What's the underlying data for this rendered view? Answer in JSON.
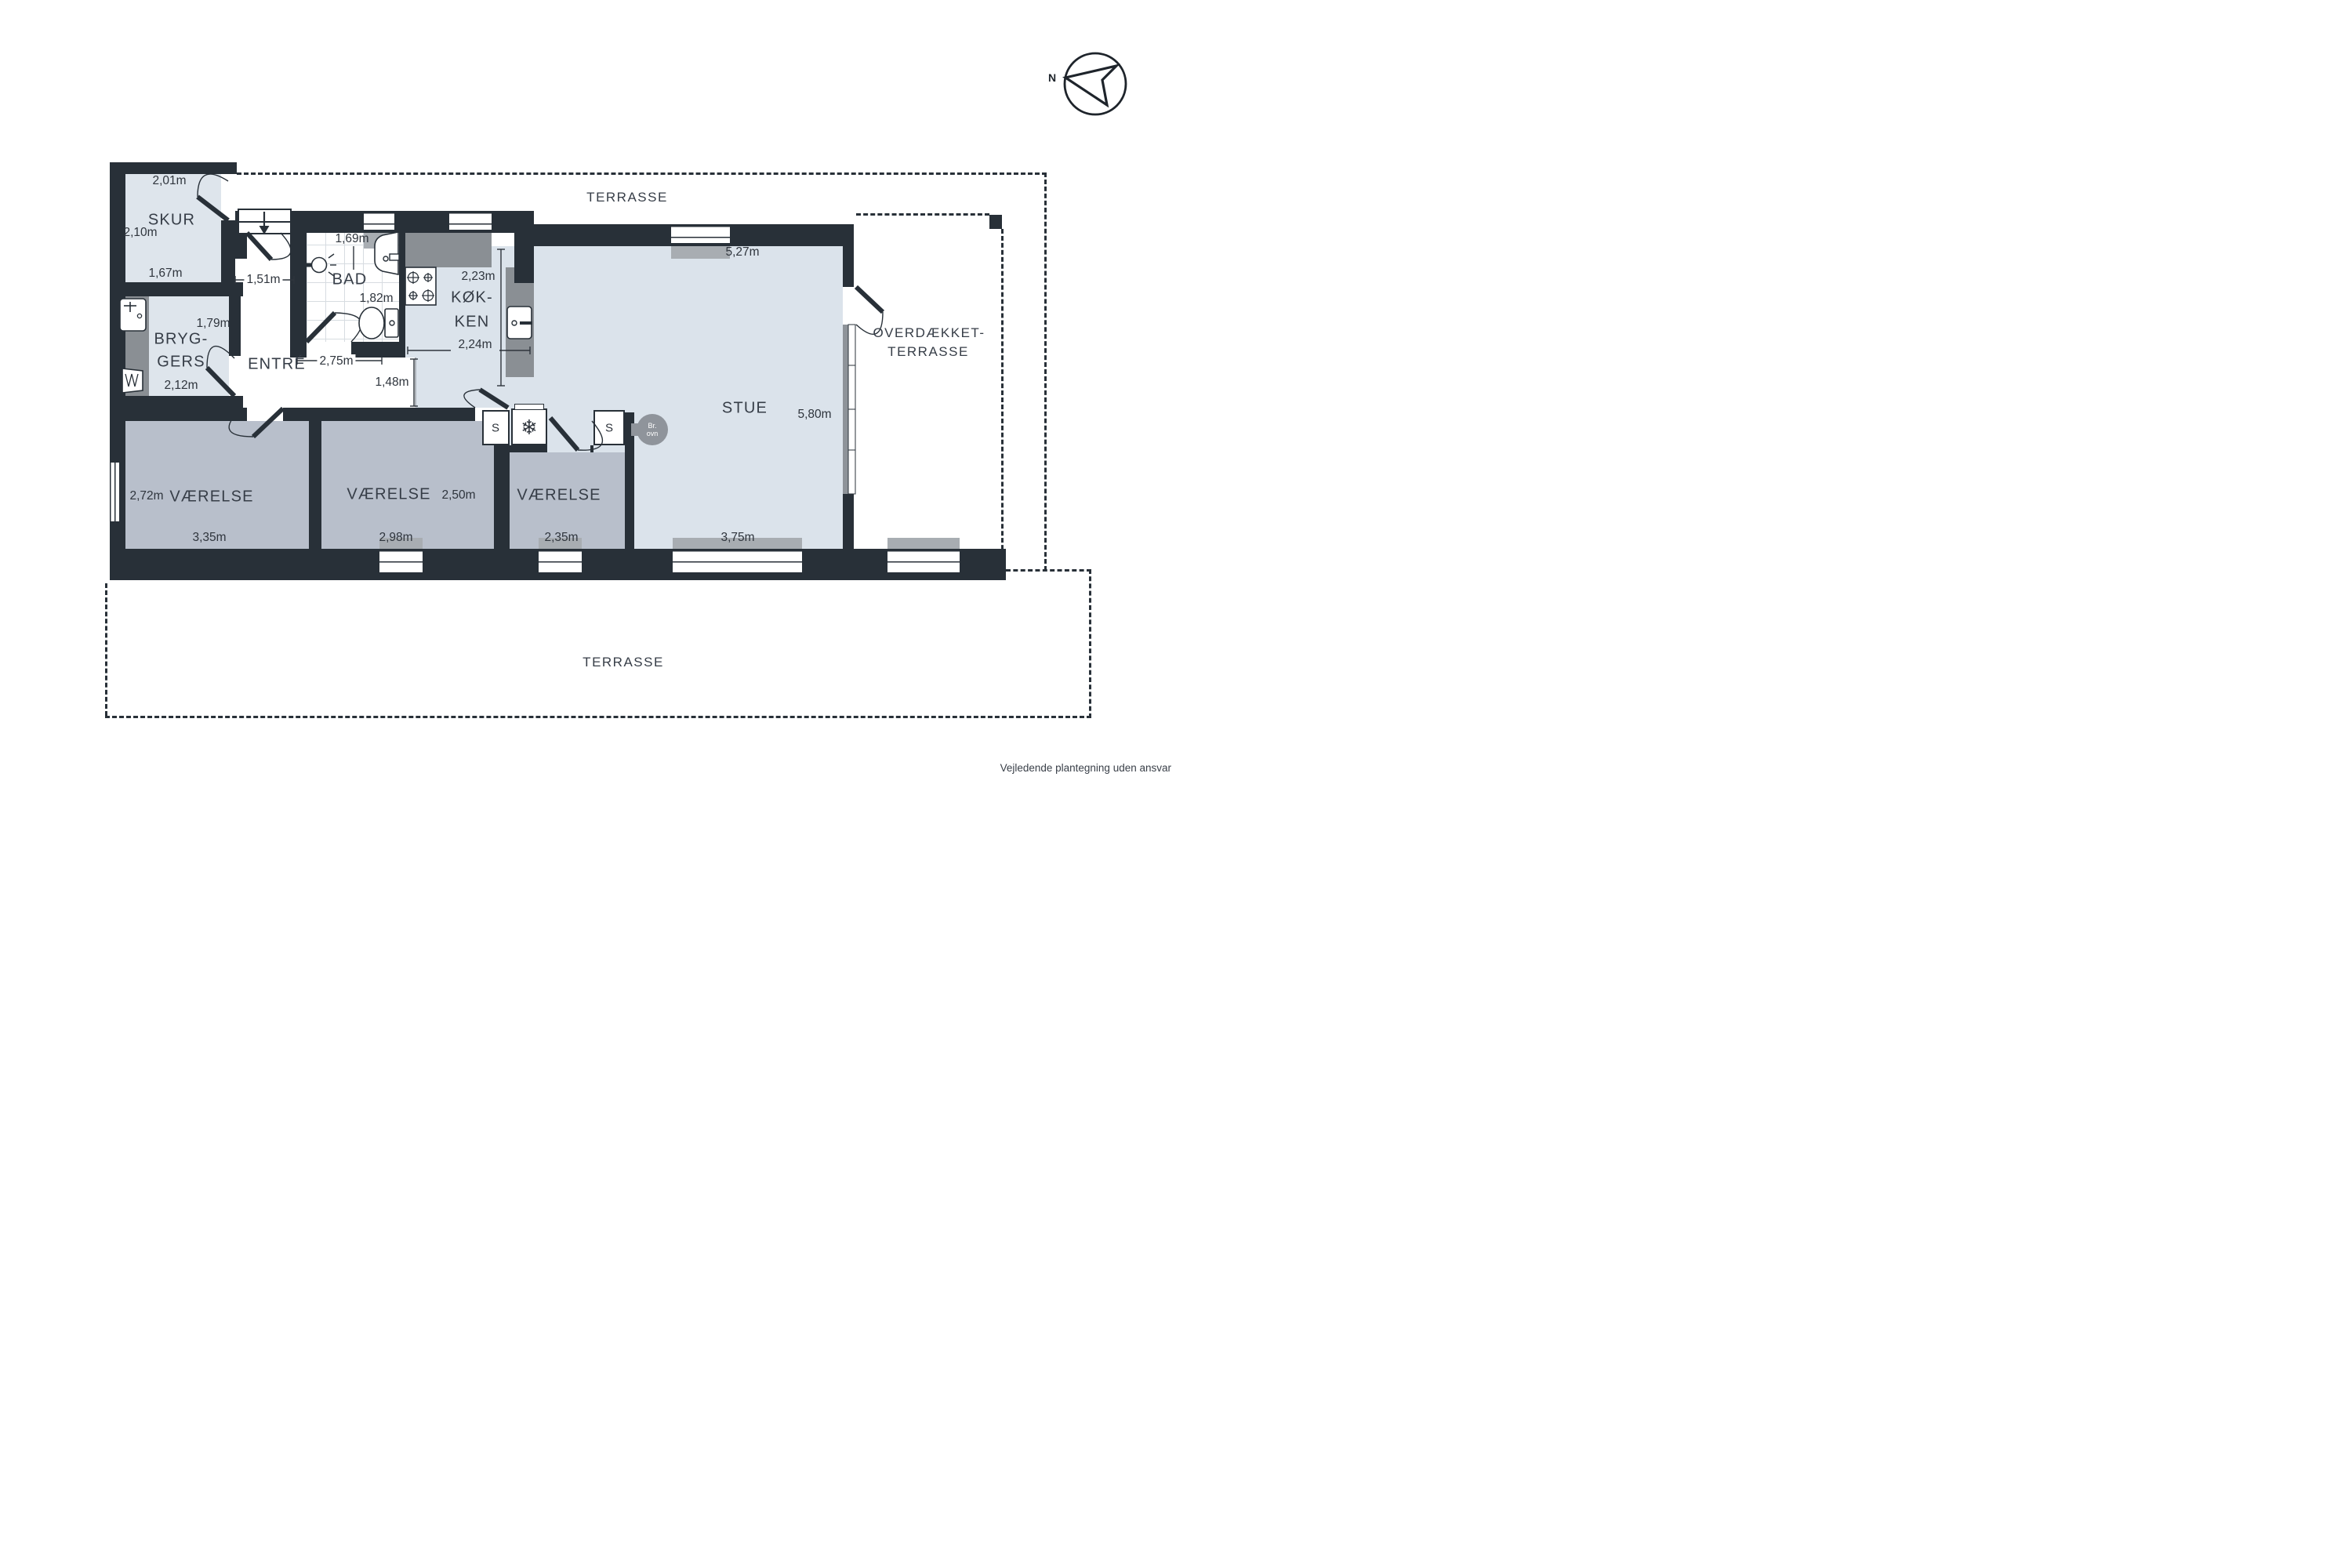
{
  "compass": {
    "north": "N"
  },
  "labels": {
    "terrasse_top": "TERRASSE",
    "terrasse_bottom": "TERRASSE",
    "skur": "SKUR",
    "bad": "BAD",
    "koek_1": "KØK-",
    "koek_2": "KEN",
    "bryg_1": "BRYG-",
    "bryg_2": "GERS",
    "entre": "ENTRÉ",
    "stue": "STUE",
    "vaerelse_1": "VÆRELSE",
    "vaerelse_2": "VÆRELSE",
    "vaerelse_3": "VÆRELSE",
    "overdaekket_1": "OVERDÆKKET-",
    "overdaekket_2": "TERRASSE"
  },
  "measurements": {
    "skur_top": "2,01m",
    "skur_left": "2,10m",
    "skur_bottom": "1,67m",
    "entre_door": "1,51m",
    "bad_top": "1,69m",
    "bad_height": "1,82m",
    "hall_width": "2,75m",
    "bryggers_top": "1,79m",
    "bryggers_bottom": "2,12m",
    "hall_depth": "1,48m",
    "koekken_top": "2,23m",
    "koekken_bottom": "2,24m",
    "stue_top": "5,27m",
    "stue_right": "5,80m",
    "stue_bottom": "3,75m",
    "v1_left": "2,72m",
    "v1_bottom": "3,35m",
    "v2_right": "2,50m",
    "v2_bottom": "2,98m",
    "v3_bottom": "2,35m"
  },
  "appliances": {
    "cabinet_1": "S",
    "cabinet_2": "S",
    "freezer_icon": "❄",
    "wood_stove_1": "Br.",
    "wood_stove_2": "ovn"
  },
  "footer": {
    "disclaimer": "Vejledende plantegning uden ansvar"
  },
  "colors": {
    "wall": "#283038",
    "floor_light": "#dbe3eb",
    "floor_bedroom": "#b8bfcb",
    "counter": "#8a8f94",
    "stove_circle": "#8f949b"
  }
}
